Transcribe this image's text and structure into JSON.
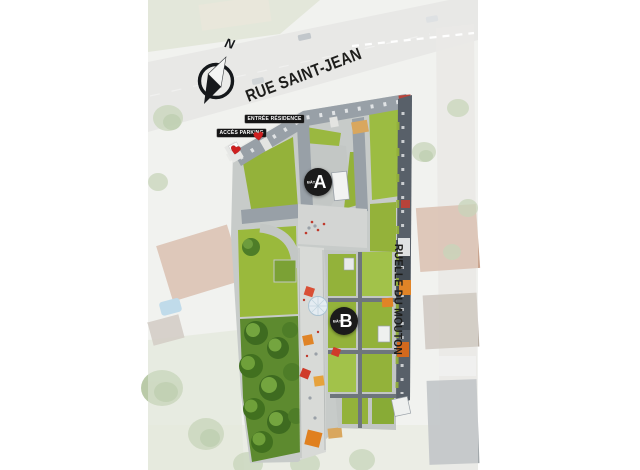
{
  "page": {
    "width": 640,
    "height": 470,
    "background": "#ffffff"
  },
  "plan": {
    "compass": {
      "letter": "N"
    },
    "streets": [
      {
        "name": "RUE SAINT-JEAN"
      },
      {
        "name": "RUELLE DU MOUTON"
      }
    ],
    "access_points": [
      {
        "label": "ACCÈS PARKING"
      },
      {
        "label": "ENTRÉE RÉSIDENCE"
      }
    ],
    "buildings": [
      {
        "prefix": "BÂT.",
        "letter": "A"
      },
      {
        "prefix": "BÂT.",
        "letter": "B"
      }
    ],
    "colors": {
      "lawn_green": "#94b23a",
      "tree_green": "#4e7d28",
      "roof_gray": "#98a0a7",
      "dark_strip": "#586069",
      "paving": "#d6d8d7",
      "parasol_orange": "#e08427",
      "accent_red": "#c0392b",
      "marker_black": "#1b1b1b",
      "street_text": "#1d1d1b",
      "canopy_blue": "#e5eef4"
    }
  }
}
